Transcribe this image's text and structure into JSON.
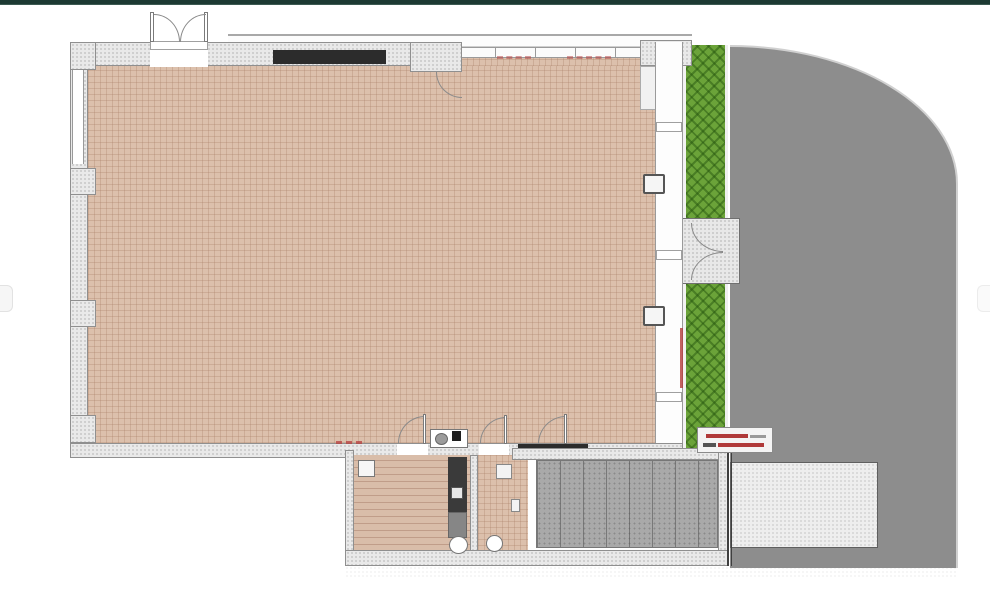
{
  "canvas": {
    "width": 990,
    "height": 600,
    "background": "#ffffff"
  },
  "chrome": {
    "top_bar": {
      "color": "#1d3a33"
    },
    "side_tabs": {
      "left": {
        "shape": "rounded-tab"
      },
      "right": {
        "shape": "rounded-tab"
      }
    }
  },
  "palette": {
    "floor_tile": "#dcc0ac",
    "floor_grid_line": "#a77c65",
    "wood_floor": "#d9bda9",
    "wall_fill": "#e9e9e9",
    "wall_edge": "#8f8f8f",
    "hedge_green": "#6ba339",
    "hedge_hatch": "#225a0c",
    "driveway_gray": "#8d8d8d",
    "garage_tile_gray": "#a9a9a9",
    "patio_light": "#eeeeee",
    "counter_black": "#2c2c2c",
    "annotation_red": "#b43b3b",
    "top_bar_teal": "#1d3a33"
  },
  "plan": {
    "rooms": [
      {
        "name": "main-hall",
        "floor": "pink-tile-grid"
      },
      {
        "name": "lower-left-room",
        "floor": "wood-planks"
      },
      {
        "name": "lower-small-room",
        "floor": "pink-tile-grid"
      },
      {
        "name": "garage",
        "floor": "gray-tiles"
      }
    ],
    "outdoor": [
      {
        "name": "hedge-strip",
        "texture": "cross-hatched-green"
      },
      {
        "name": "driveway",
        "texture": "flat-gray",
        "edge": "curved-top-right"
      },
      {
        "name": "garden-gate",
        "texture": "stippled-gray",
        "doors": 2
      },
      {
        "name": "rear-patio",
        "texture": "stippled-light"
      }
    ],
    "features": [
      {
        "name": "double-entry-door",
        "location": "top-wall-left"
      },
      {
        "name": "black-counter-top-wall"
      },
      {
        "name": "window-wall-mullions",
        "location": "top-wall-right"
      },
      {
        "name": "pier-with-door",
        "location": "top-wall-center"
      },
      {
        "name": "sink-unit",
        "location": "bottom-wall-center"
      },
      {
        "name": "black-counter-garage-lintel"
      },
      {
        "name": "wall-columns",
        "count": 2,
        "location": "right-wall"
      },
      {
        "name": "wc-fixtures",
        "count": 2,
        "location": "lower-rooms"
      },
      {
        "name": "dark-utility-unit",
        "location": "lower-left-room"
      }
    ],
    "annotations": [
      {
        "name": "red-dimension-marks-top",
        "color": "#b43b3b",
        "legible": false
      },
      {
        "name": "red-dimension-marks-bottom-wall",
        "color": "#b43b3b",
        "legible": false
      },
      {
        "name": "red-vertical-dimension-right-wall",
        "color": "#b43b3b",
        "legible": false
      },
      {
        "name": "red-text-label-box",
        "lines": 2,
        "color": "#b43b3b",
        "legible": false
      }
    ]
  }
}
